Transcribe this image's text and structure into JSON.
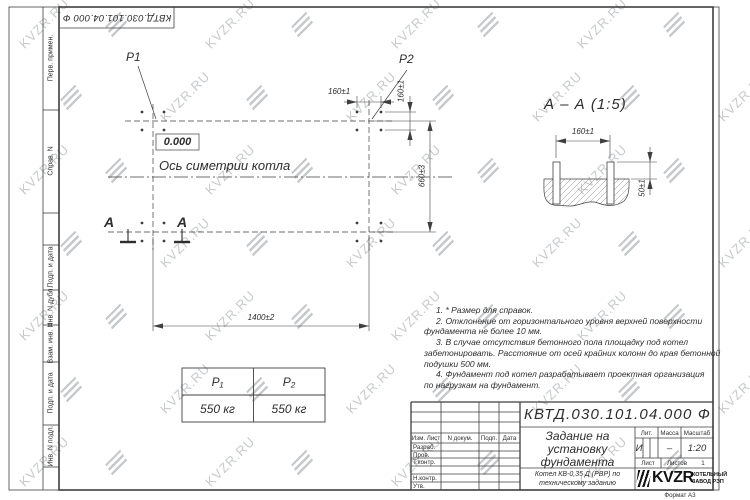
{
  "colors": {
    "ink": "#2e2e2e",
    "line": "#3f3f3f",
    "watermark": "#c7cacc"
  },
  "watermark": {
    "text": "KVZR.RU"
  },
  "frame": {
    "top_stamp_text": "КВТД.030.101.04.000  Ф",
    "format_label": "Формат А3",
    "margin_labels": {
      "perv": "Перв. примен.",
      "sprav": "Справ. N",
      "podp1": "Подп. и дата",
      "inv_dubl": "Инв. N дубл.",
      "vzam": "Взам. инв. N",
      "podp2": "Подп. и дата",
      "inv_podl": "Инв. N подл."
    }
  },
  "plan": {
    "p1_label": "P1",
    "p2_label": "P2",
    "level_mark": "0.000",
    "axis_label": "Ось симетрии котла",
    "dim_bolt_spacing_x": "160±1",
    "dim_bolt_spacing_y": "160±1",
    "dim_width": "1400±2",
    "dim_depth": "660±3",
    "section_letter_1": "А",
    "section_letter_2": "А"
  },
  "section_view": {
    "title": "А – А (1:5)",
    "dim_bolt_spacing": "160±1",
    "dim_bolt_height": "50±1"
  },
  "loads_table": {
    "col1_header": "P₁",
    "col2_header": "P₂",
    "col1_value": "550 кг",
    "col2_value": "550 кг"
  },
  "notes": {
    "lines": [
      "1. * Размер для справок.",
      "2. Отклонение от горизонтального уровня верхней поверхности",
      "фундамента не более 10 мм.",
      "3. В случае отсутствия бетонного пола площадку под котел",
      "забетонировать. Расстояние от осей крайних колонн до края бетонной",
      "подушки 500 мм.",
      "4. Фундамент под котел разрабатывает проектная организация",
      "по нагрузкам на фундамент."
    ]
  },
  "title_block": {
    "doc_number": "КВТД.030.101.04.000  Ф",
    "title_line1": "Задание на",
    "title_line2": "установку",
    "title_line3": "фундамента",
    "subtitle_line1": "Котел КВ-0,35 Д (РВР) по",
    "subtitle_line2": "техническому заданию",
    "col_izm": "Изм. Лист",
    "col_doc": "N докум.",
    "col_podp": "Подп.",
    "col_data": "Дата",
    "row_razrab": "Разраб.",
    "row_prov": "Пров.",
    "row_tkontr": "Т.контр.",
    "row_nkontr": "Н.контр.",
    "row_utv": "Утв.",
    "lit_label": "Лит.",
    "mass_label": "Масса",
    "scale_label": "Масштаб",
    "lit_value": "И",
    "mass_value": "–",
    "scale_value": "1:20",
    "sheet_label": "Лист",
    "sheets_label": "Листов",
    "sheets_value": "1",
    "company_name": "KVZR",
    "company_line1": "КОТЕЛЬНЫЙ",
    "company_line2": "ЗАВОД РЭП"
  }
}
